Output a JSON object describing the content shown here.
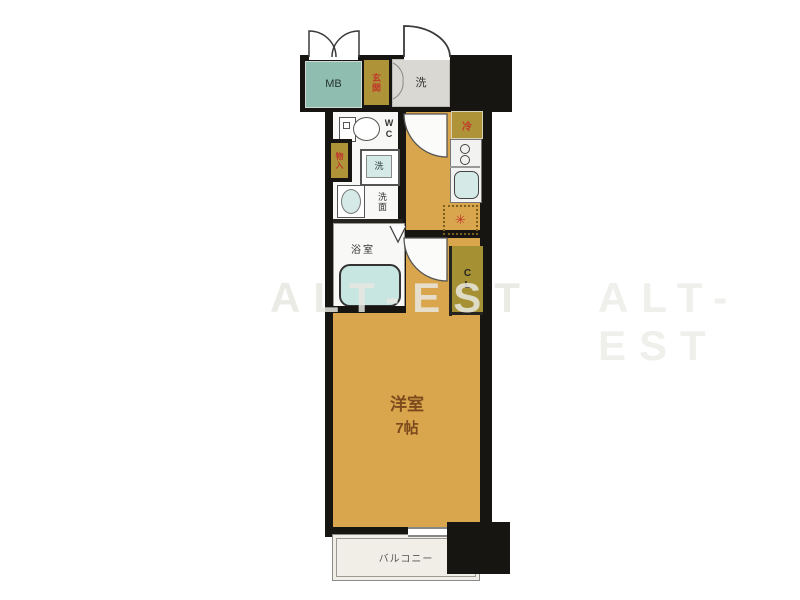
{
  "watermark": {
    "text": "ALT-EST"
  },
  "floorplan": {
    "labels": {
      "meter_box": "MB",
      "entrance": "玄関",
      "entry_hall": "洗",
      "toilet": "WC",
      "storage": "物入",
      "washer": "洗",
      "washroom": "洗面",
      "bathroom": "浴室",
      "fridge": "冷",
      "stove": "✳",
      "closet": "CL",
      "main_room_name": "洋室",
      "main_room_size": "7帖",
      "balcony": "バルコニー"
    },
    "colors": {
      "room_tan": "#D9A54D",
      "cabinet_olive": "#AE9338",
      "meter_box_teal": "#8FBDB0",
      "entry_gray": "#D9D8D3",
      "fixture_blue": "#D5E9E6",
      "wall_black": "#171512",
      "label_red": "#C0392B",
      "room_label_brown": "#7C4A1C"
    }
  }
}
